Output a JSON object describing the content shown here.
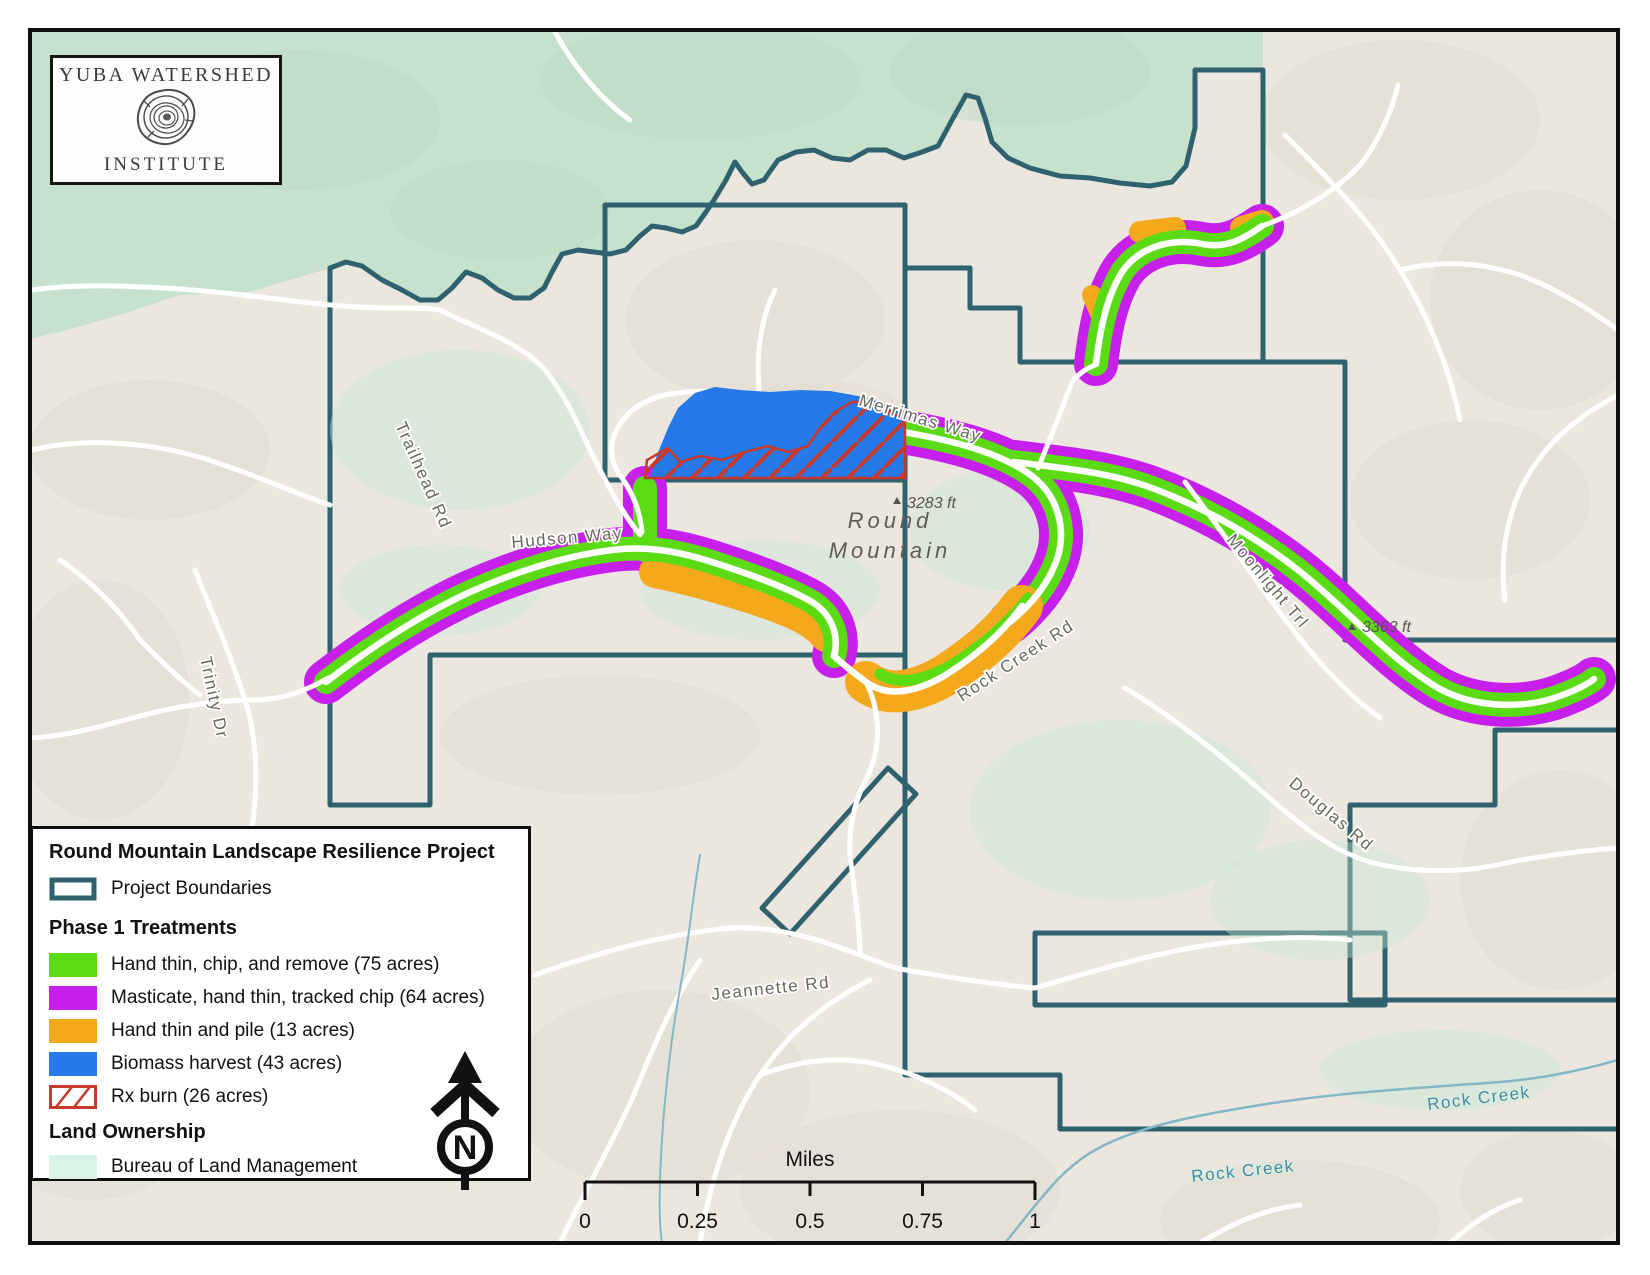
{
  "logo": {
    "line1": "YUBA WATERSHED",
    "line2": "INSTITUTE"
  },
  "legend": {
    "title": "Round Mountain Landscape Resilience Project",
    "project_boundaries_label": "Project Boundaries",
    "phase_header": "Phase 1 Treatments",
    "treatments": [
      {
        "key": "hand-thin-chip-remove",
        "label": "Hand thin, chip, and remove (75 acres)",
        "color": "#5BDB13"
      },
      {
        "key": "masticate-hand-thin-tracked-chip",
        "label": "Masticate, hand thin, tracked chip (64 acres)",
        "color": "#C820EC"
      },
      {
        "key": "hand-thin-and-pile",
        "label": "Hand thin and pile (13 acres)",
        "color": "#F4A81C"
      },
      {
        "key": "biomass-harvest",
        "label": "Biomass harvest (43 acres)",
        "color": "#2579E8"
      },
      {
        "key": "rx-burn",
        "label": "Rx burn (26 acres)",
        "color": "#C8392C",
        "style": "hatched"
      }
    ],
    "ownership_header": "Land Ownership",
    "ownership": [
      {
        "key": "blm",
        "label": "Bureau of Land Management",
        "color": "#D9F3E6"
      }
    ]
  },
  "scale_bar": {
    "title": "Miles",
    "ticks": [
      "0",
      "0.25",
      "0.5",
      "0.75",
      "1"
    ]
  },
  "north_arrow_label": "N",
  "map_labels": {
    "trailhead_rd": "Trailhead Rd",
    "trinity_dr": "Trinity Dr",
    "hudson_way": "Hudson Way",
    "merrimas_way": "Merrimas Way",
    "rock_creek_rd": "Rock Creek Rd",
    "moonlight_trl": "Moonlight Trl",
    "douglas_rd": "Douglas Rd",
    "jeannette_rd": "Jeannette Rd",
    "rock_creek_upper": "Rock Creek",
    "rock_creek_lower": "Rock Creek",
    "mountain": {
      "line1": "Round",
      "line2": "Mountain"
    },
    "elev_round_mountain": "3283 ft",
    "elev_moonlight": "3363 ft"
  },
  "colors": {
    "project_boundary": "#2F616E",
    "hand_thin_chip_remove": "#5BDB13",
    "masticate_hand_thin_tracked_chip": "#C820EC",
    "hand_thin_and_pile": "#F4A81C",
    "biomass_harvest": "#2579E8",
    "rx_burn": "#C8392C",
    "blm_land": "#D9F3E6",
    "road": "#FFFFFF",
    "creek_label": "#4E87A0"
  }
}
